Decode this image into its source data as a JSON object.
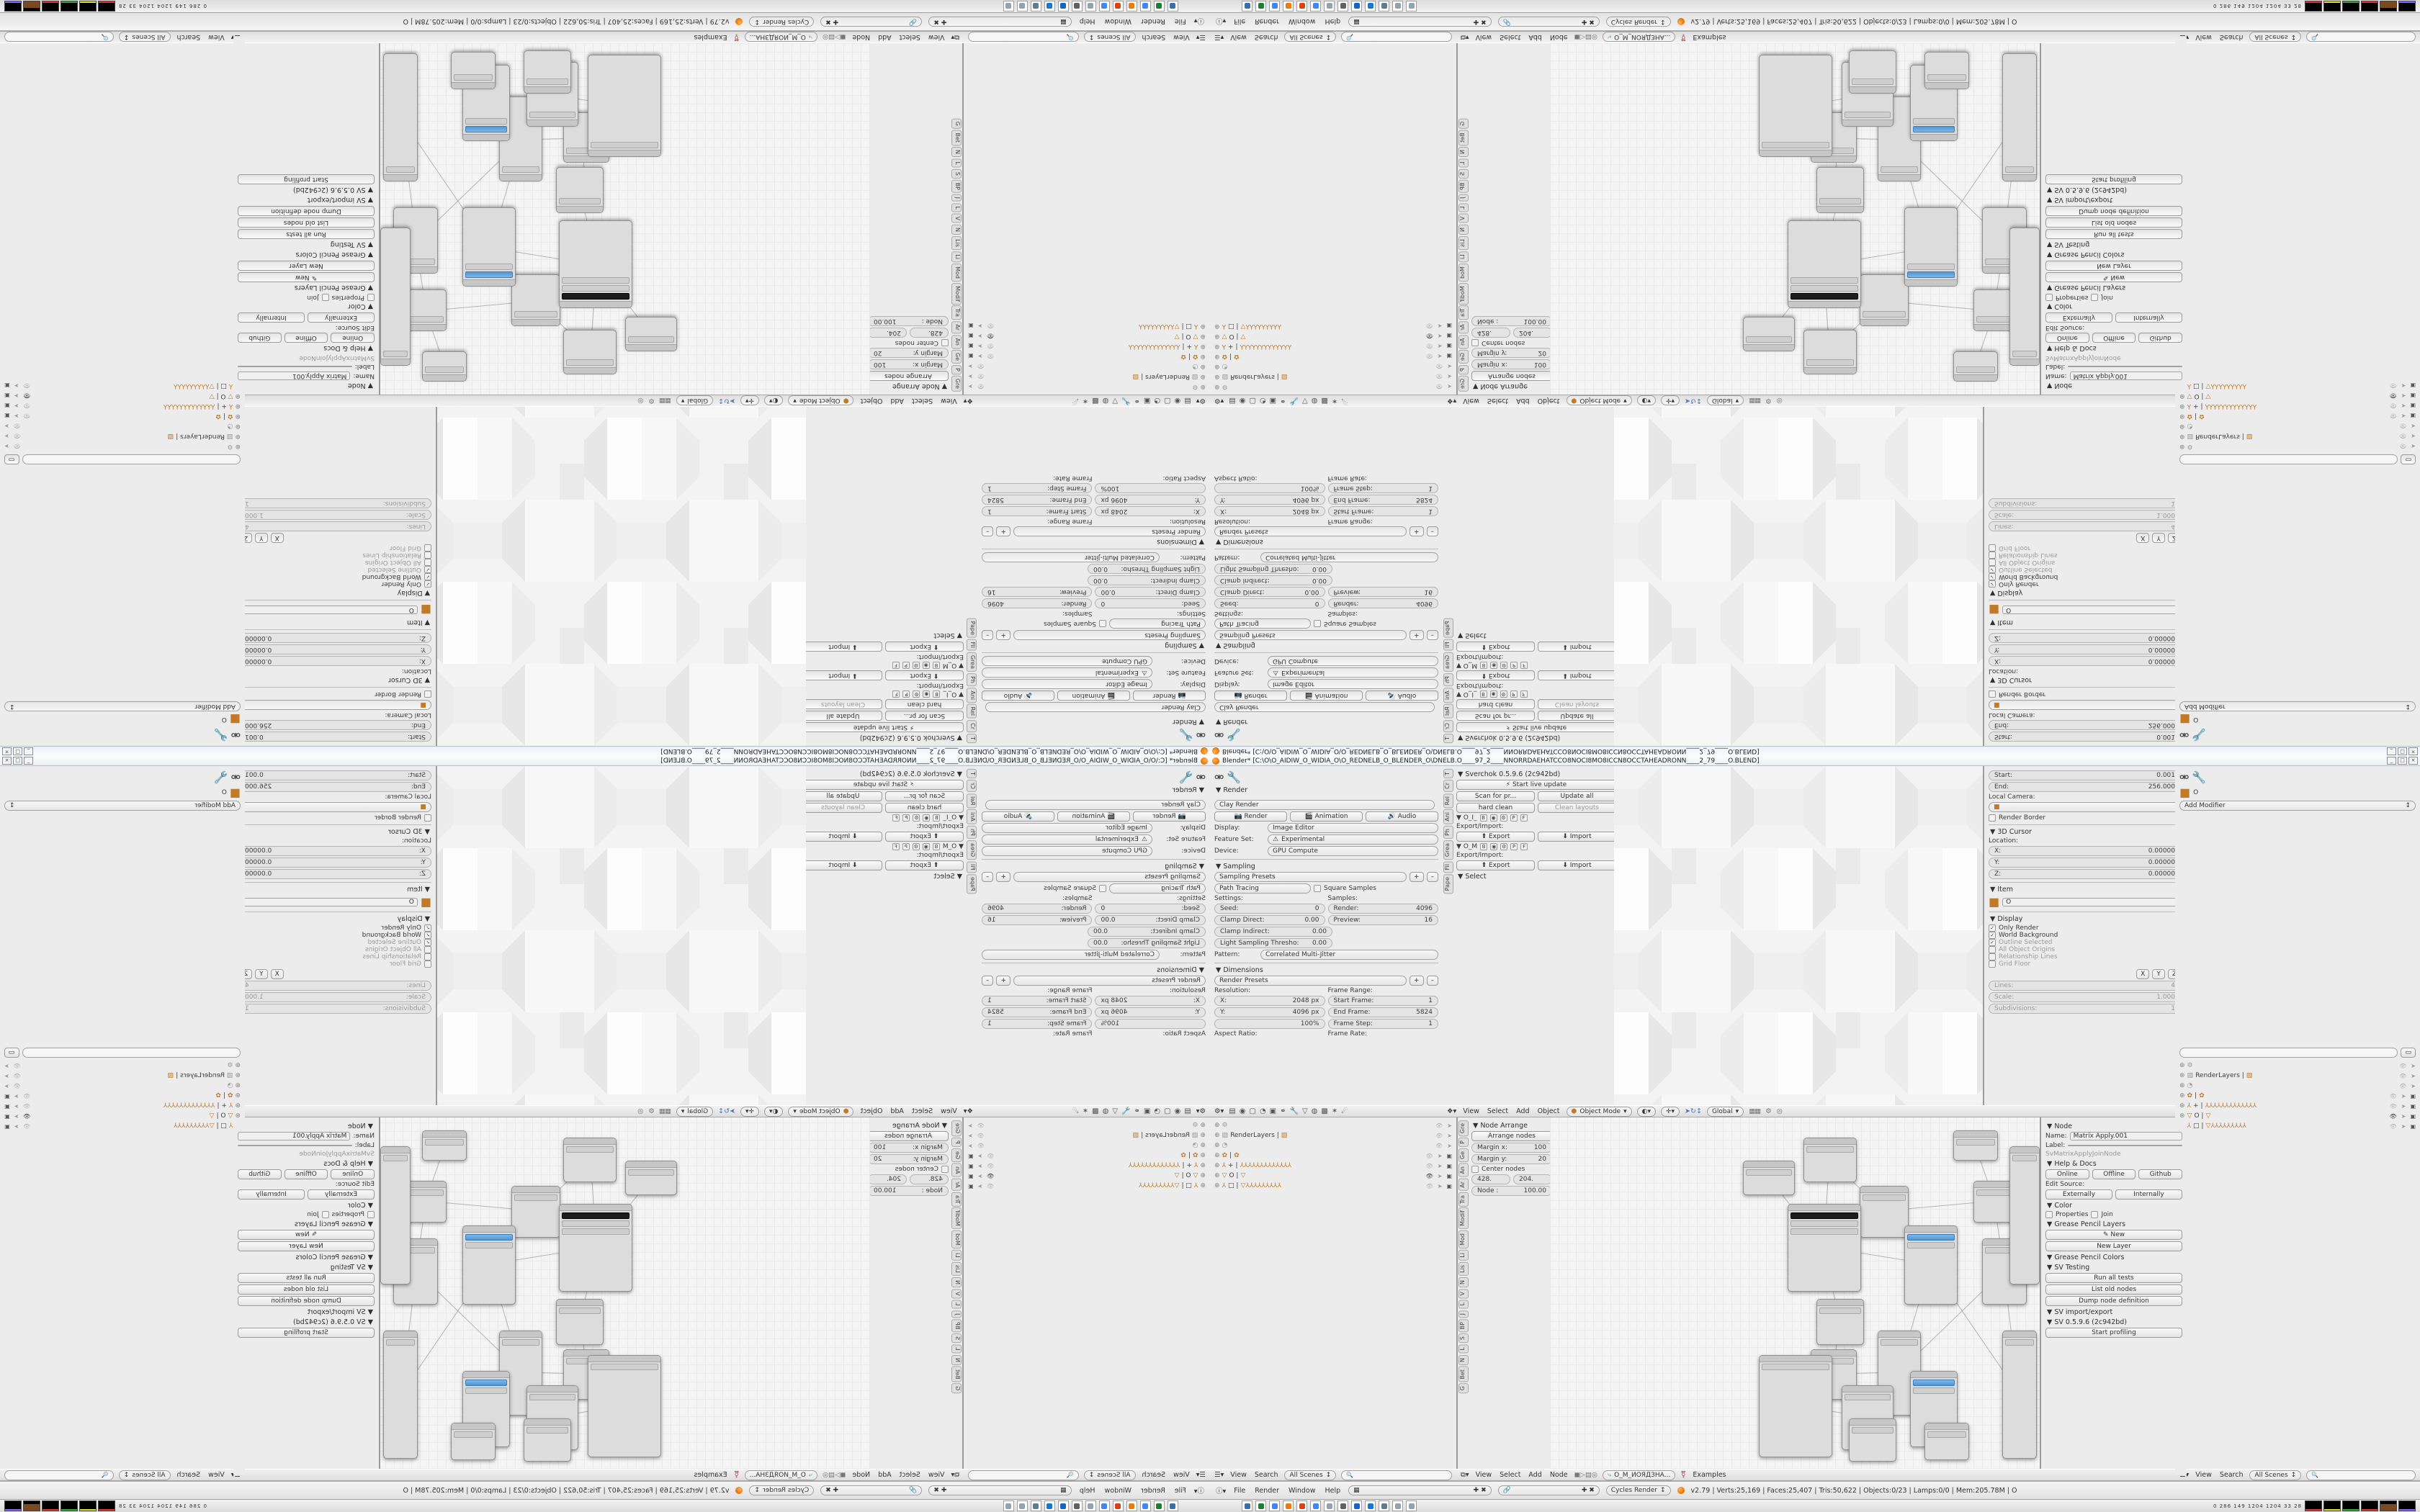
{
  "window": {
    "title": "Blender* [C:\\O\\O_AIDIW_O_WIDIA_O\\O_REDNELB_O_BLENDER_O\\DNELB.O____97_2____NNORRDAEHATCCO8NOCI8MO8ICCN8OCCTAHEADRONN____2_79____O.BLEND]",
    "minimize": "_",
    "maximize": "□",
    "close": "×"
  },
  "props_render": {
    "panel_render": "▼ Render",
    "preset": "Clay Render",
    "buttons": {
      "render": "Render",
      "animation": "Animation",
      "audio": "Audio"
    },
    "display_label": "Display:",
    "display_value": "Image Editor",
    "feature_label": "Feature Set:",
    "feature_value": "Experimental",
    "device_label": "Device:",
    "device_value": "GPU Compute",
    "panel_sampling": "▼ Sampling",
    "sampling_presets": "Sampling Presets",
    "path_tracing": "Path Tracing",
    "square_samples": "Square Samples",
    "settings_label": "Settings:",
    "samples_label": "Samples:",
    "seed_label": "Seed:",
    "seed": "0",
    "clamp_direct_label": "Clamp Direct:",
    "clamp_direct": "0.00",
    "clamp_indirect_label": "Clamp Indirect:",
    "clamp_indirect": "0.00",
    "light_thresh_label": "Light Sampling Thresho:",
    "light_thresh": "0.00",
    "render_samples_label": "Render:",
    "render_samples": "4096",
    "preview_samples_label": "Preview:",
    "preview_samples": "16",
    "pattern_label": "Pattern:",
    "pattern_value": "Correlated Multi-Jitter",
    "panel_dimensions": "▼ Dimensions",
    "render_presets": "Render Presets",
    "resolution_label": "Resolution:",
    "res_x_label": "X:",
    "res_x": "2048 px",
    "res_y_label": "Y:",
    "res_y": "4096 px",
    "res_pct": "100%",
    "frame_range_label": "Frame Range:",
    "start_frame_label": "Start Frame:",
    "start_frame": "1",
    "end_frame_label": "End Frame:",
    "end_frame": "5824",
    "frame_step_label": "Frame Step:",
    "frame_step": "1",
    "aspect_label": "Aspect Ratio:",
    "frame_rate_label": "Frame Rate:",
    "tab_icons": [
      "properties",
      "render",
      "scene",
      "world",
      "object",
      "constraints",
      "modifiers",
      "data",
      "material",
      "texture",
      "particles",
      "physics"
    ]
  },
  "tool_shelf": {
    "tabs": [
      "T",
      "Cr",
      "Rel",
      "Ani",
      "Ph",
      "Grea",
      "Fil",
      "Pape"
    ],
    "sverchok_title": "▼ Sverchok 0.5.9.6 (2c942bd)",
    "start_live": "Start live update",
    "scan": "Scan for pr...",
    "update_all": "Update all",
    "hard_clean": "hard clean",
    "clean_layouts": "Clean layouts",
    "groups": [
      {
        "name": "▼  O_I_",
        "flags": [
          "B",
          "◉",
          "⚙",
          "P",
          "F"
        ],
        "export_label": "Export/Import:",
        "export": "Export",
        "import": "Import"
      },
      {
        "name": "▼  O_M",
        "flags": [
          "B",
          "◉",
          "⚙",
          "P",
          "F"
        ],
        "export_label": "Export/Import:",
        "export": "Export",
        "import": "Import"
      }
    ],
    "select_title": "▼ Select"
  },
  "viewport": {
    "header": {
      "menus": [
        "View",
        "Select",
        "Add",
        "Object"
      ],
      "mode": "Object Mode",
      "orientation": "Global"
    },
    "npanel": {
      "start_label": "Start:",
      "start": "0.001",
      "end_label": "End:",
      "end": "256.000",
      "local_camera": "Local Camera:",
      "render_border": "Render Border",
      "cursor_title": "▼ 3D Cursor",
      "location_label": "Location:",
      "x_label": "X:",
      "x": "0.00000",
      "y_label": "Y:",
      "y": "0.00000",
      "z_label": "Z:",
      "z": "0.00000",
      "item_title": "▼ Item",
      "item_name": "O",
      "display_title": "▼ Display",
      "checks": [
        {
          "on": true,
          "dim": false,
          "label": "Only Render"
        },
        {
          "on": true,
          "dim": false,
          "label": "World Background"
        },
        {
          "on": true,
          "dim": true,
          "label": "Outline Selected"
        },
        {
          "on": false,
          "dim": true,
          "label": "All Object Origins"
        },
        {
          "on": false,
          "dim": true,
          "label": "Relationship Lines"
        },
        {
          "on": false,
          "dim": true,
          "label": "Grid Floor"
        }
      ],
      "axis": [
        "X",
        "Y",
        "Z"
      ],
      "lines_label": "Lines:",
      "lines": "4",
      "scale_label": "Scale:",
      "scale": "1.000",
      "subdiv_label": "Subdivisions:",
      "subdiv": "1"
    }
  },
  "props_modifier": {
    "breadcrumb": "O",
    "add_modifier": "Add Modifier"
  },
  "outliner": {
    "header_menus": [
      "View",
      "Search"
    ],
    "scenes": "All Scenes",
    "search_placeholder": "",
    "rows": [
      {
        "icon": "⚙",
        "cls": "oicg",
        "name": "",
        "eye": false,
        "cam": false
      },
      {
        "icon": "▧",
        "cls": "oicg",
        "name": "RenderLayers  |",
        "extra": "▧",
        "eye": false,
        "cam": false
      },
      {
        "icon": "◔",
        "cls": "oicg",
        "name": "",
        "eye": false,
        "cam": false
      },
      {
        "icon": "✿",
        "cls": "oic",
        "name": "|",
        "extra": "✿",
        "eye": false,
        "cam": true
      },
      {
        "icon": "⅄",
        "cls": "oic",
        "name": "+  |",
        "extra": "⅄⅄⅄⅄⅄⅄⅄⅄⅄⅄⅄⅄⅄",
        "eye": false,
        "cam": true
      },
      {
        "icon": "▽",
        "cls": "oic",
        "name": "O  |",
        "extra": "▽",
        "eye": true,
        "cam": true
      },
      {
        "icon": "⅄",
        "cls": "oic",
        "name": "□  |",
        "extra": "▽⅄⅄⅄⅄⅄⅄⅄⅄⅄",
        "eye": false,
        "cam": true
      }
    ]
  },
  "node_editor": {
    "tabs": [
      "Gre",
      "P",
      "Ge",
      "An",
      "Ar",
      "Tra",
      "Modif",
      "Mod",
      "Li",
      "Lis",
      "N",
      "V",
      "L",
      "J",
      "BP",
      "S",
      "L",
      "N",
      "Bet",
      "G"
    ],
    "node_arrange": {
      "title": "▼ Node Arrange",
      "arrange_btn": "Arrange nodes",
      "margin_x_label": "Margin x:",
      "margin_x": "100",
      "margin_y_label": "Margin y:",
      "margin_y": "20",
      "center_nodes": "Center nodes",
      "val1": "428.",
      "val2": "204.",
      "node_label": "Node :",
      "node_value": "100.00"
    },
    "npanel": {
      "node_title": "▼ Node",
      "name_label": "Name:",
      "name": "Matrix Apply.001",
      "label_label": "Label:",
      "label": "",
      "idname": "SvMatrixApplyJoinNode",
      "help_title": "▼ Help & Docs",
      "help_btns": [
        "Online",
        "Offline",
        "Github"
      ],
      "edit_source": "Edit Source:",
      "source_btns": [
        "Externally",
        "Internally"
      ],
      "color_title": "▼ Color",
      "properties_row": "Properties",
      "join_row": "Join",
      "gp_layers_title": "▼ Grease Pencil Layers",
      "gp_new": "New",
      "gp_new_layer": "New Layer",
      "gp_colors_title": "▼ Grease Pencil Colors",
      "sv_testing_title": "▼ SV Testing",
      "run_tests": "Run all tests",
      "list_old": "List old nodes",
      "dump_def": "Dump node definition",
      "sv_ie_title": "▼ SV import/export",
      "sv_ver_title": "▼ SV 0.5.9.6 (2c942bd)",
      "profiling": "Start profiling"
    },
    "header": {
      "menus": [
        "View",
        "Select",
        "Add",
        "Node"
      ],
      "tree_name": "O_M_ИОЯДЗНА...",
      "examples": "Examples"
    },
    "graph": {
      "nodes": [
        {
          "style": "left:268px;top:60px;width:70px;height:46px",
          "cls": ""
        },
        {
          "style": "left:352px;top:28px;width:72px;height:60px",
          "cls": ""
        },
        {
          "style": "left:430px;top:95px;width:66px;height:70px",
          "cls": ""
        },
        {
          "style": "left:330px;top:120px;width:100px;height:120px",
          "cls": "dark"
        },
        {
          "style": "left:492px;top:150px;width:72px;height:108px",
          "cls": "blue"
        },
        {
          "style": "left:370px;top:252px;width:64px;height:62px",
          "cls": ""
        },
        {
          "style": "left:362px;top:322px;width:62px;height:68px",
          "cls": ""
        },
        {
          "style": "left:455px;top:296px;width:58px;height:116px",
          "cls": ""
        },
        {
          "style": "left:560px;top:18px;width:60px;height:40px",
          "cls": ""
        },
        {
          "style": "left:588px;top:88px;width:58px;height:56px",
          "cls": ""
        },
        {
          "style": "left:600px;top:168px;width:60px;height:90px",
          "cls": ""
        },
        {
          "style": "left:290px;top:330px;width:100px;height:140px",
          "cls": ""
        },
        {
          "style": "left:405px;top:372px;width:70px;height:88px",
          "cls": ""
        },
        {
          "style": "left:415px;top:418px;width:64px;height:58px",
          "cls": ""
        },
        {
          "style": "left:500px;top:352px;width:64px;height:104px",
          "cls": "blue"
        },
        {
          "style": "left:520px;top:424px;width:60px;height:50px",
          "cls": ""
        },
        {
          "style": "left:628px;top:296px;width:46px;height:176px",
          "cls": ""
        },
        {
          "style": "left:638px;top:40px;width:40px;height:190px",
          "cls": ""
        }
      ],
      "wires": [
        [
          0,
          3
        ],
        [
          1,
          2
        ],
        [
          1,
          3
        ],
        [
          2,
          4
        ],
        [
          3,
          5
        ],
        [
          3,
          4
        ],
        [
          4,
          7
        ],
        [
          5,
          6
        ],
        [
          6,
          11
        ],
        [
          7,
          10
        ],
        [
          2,
          9
        ],
        [
          8,
          9
        ],
        [
          9,
          10
        ],
        [
          11,
          12
        ],
        [
          12,
          13
        ],
        [
          12,
          14
        ],
        [
          14,
          15
        ],
        [
          10,
          16
        ],
        [
          4,
          16
        ],
        [
          6,
          7
        ]
      ]
    }
  },
  "info_bar": {
    "menus": [
      "File",
      "Render",
      "Window",
      "Help"
    ],
    "engine": "Cycles Render",
    "stats": "v2.79 | Verts:25,169 | Faces:25,407 | Tris:50,622 | Objects:0/23 | Lamps:0/0 | Mem:205.78M | O"
  },
  "taskbar": {
    "icons": [
      "display-app",
      "green-app",
      "chrome",
      "blender",
      "spiral-app",
      "chrome-2",
      "notepad",
      "speaker",
      "floppy-64",
      "image-viewer",
      "calculator",
      "notepad-2",
      "notepad-3"
    ],
    "icon_colors": [
      "#3a6ea5",
      "#1e7d32",
      "#4285f4",
      "#e87d0d",
      "#d84315",
      "#4285f4",
      "#90a4ae",
      "#616161",
      "#1565c0",
      "#1976d2",
      "#607d8b",
      "#90a4ae",
      "#90a4ae"
    ],
    "monitor_numbers": "0   286   149   1204 1204   33    28",
    "monitor_graphs": 6
  }
}
